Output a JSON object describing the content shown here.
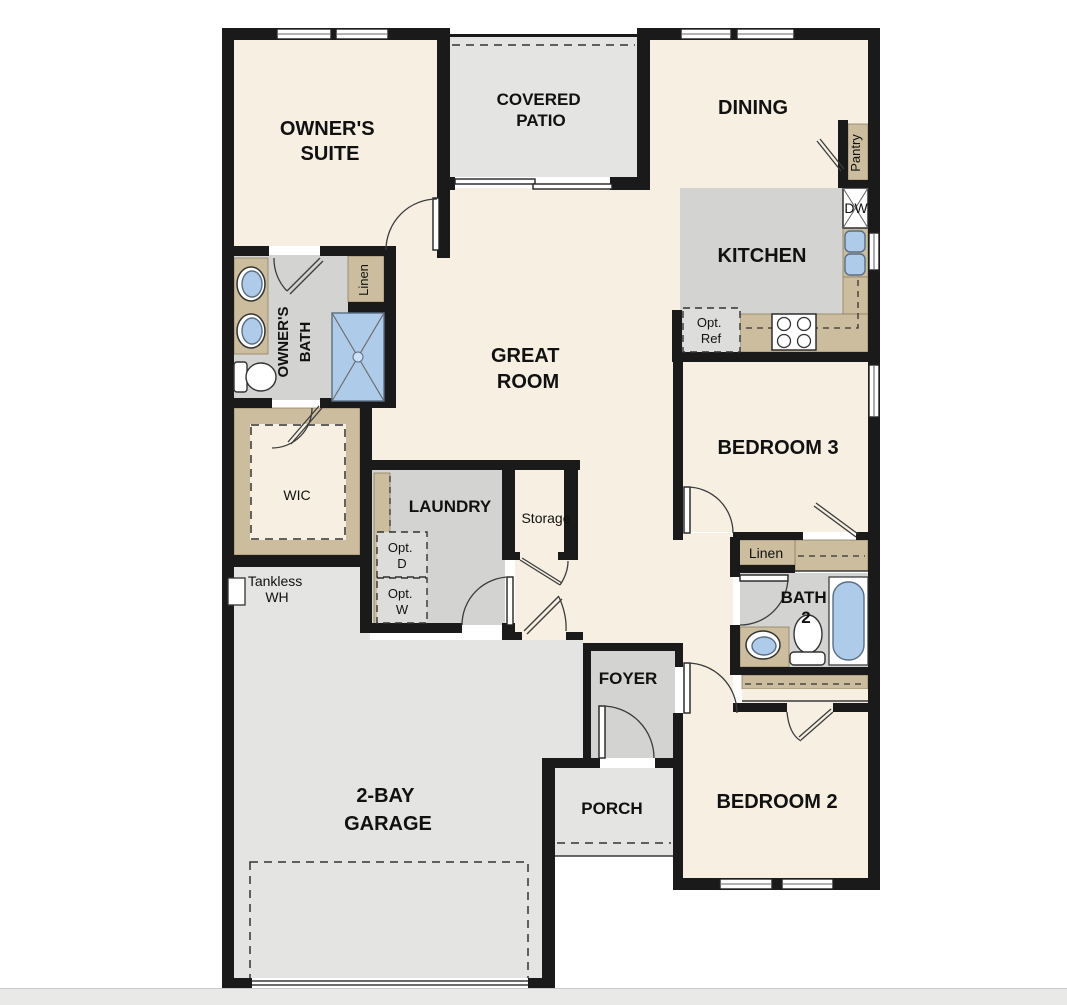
{
  "colors": {
    "wall": "#1a1a1a",
    "cream": "#f6efe2",
    "room_gray": "#d3d3d1",
    "outdoor_gray": "#e4e4e2",
    "tan": "#cbbd9e",
    "tan_line": "#8f7f5f",
    "optional_gray": "#dddddc",
    "fixture_blue": "#aecbe9",
    "fixture_stroke": "#5a6e84",
    "line": "#3a3a3a",
    "footer": "#e9e9e8"
  },
  "labels": {
    "owners_suite": [
      "OWNER'S",
      "SUITE"
    ],
    "covered_patio": [
      "COVERED",
      "PATIO"
    ],
    "dining": "DINING",
    "pantry": "Pantry",
    "kitchen": "KITCHEN",
    "dishwasher": "DW",
    "opt_ref": [
      "Opt.",
      "Ref"
    ],
    "owners_bath": [
      "OWNER'S",
      "BATH"
    ],
    "linen_owners": "Linen",
    "great_room": [
      "GREAT",
      "ROOM"
    ],
    "bedroom_3": "BEDROOM 3",
    "wic": "WIC",
    "laundry": "LAUNDRY",
    "storage": "Storage",
    "opt_dryer": [
      "Opt.",
      "D"
    ],
    "opt_washer": [
      "Opt.",
      "W"
    ],
    "tankless_wh": [
      "Tankless",
      "WH"
    ],
    "linen_hall": "Linen",
    "bath_2": [
      "BATH",
      "2"
    ],
    "foyer": "FOYER",
    "porch": "PORCH",
    "bedroom_2": "BEDROOM 2",
    "garage": [
      "2-BAY",
      "GARAGE"
    ]
  }
}
